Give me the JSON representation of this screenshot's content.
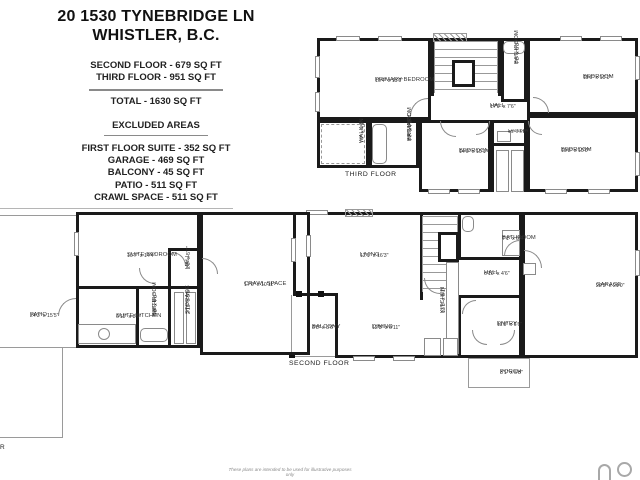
{
  "header": {
    "title_line1": "20 1530 TYNEBRIDGE LN",
    "title_line2": "WHISTLER, B.C.",
    "included": [
      "SECOND FLOOR - 679 SQ FT",
      "THIRD FLOOR - 951 SQ FT"
    ],
    "total": "TOTAL - 1630 SQ FT",
    "excluded_heading": "EXCLUDED AREAS",
    "excluded": [
      "FIRST FLOOR SUITE - 352 SQ FT",
      "GARAGE - 469 SQ FT",
      "BALCONY - 45 SQ FT",
      "PATIO - 511 SQ FT",
      "CRAWL SPACE - 511 SQ FT"
    ]
  },
  "colors": {
    "wall": "#1a1a1a",
    "thin_line": "#9a9a9a",
    "label_text": "#333333"
  },
  "floors": [
    {
      "name": "THIRD FLOOR",
      "walls": [
        {
          "t": "rect",
          "x": 317,
          "y": 38,
          "w": 114,
          "h": 82
        },
        {
          "t": "rect",
          "x": 431,
          "y": 38,
          "w": 70,
          "h": 58,
          "s": "tlr"
        },
        {
          "t": "rect",
          "x": 501,
          "y": 38,
          "w": 26,
          "h": 64
        },
        {
          "t": "rect",
          "x": 527,
          "y": 38,
          "w": 111,
          "h": 77
        },
        {
          "t": "rect",
          "x": 317,
          "y": 120,
          "w": 52,
          "h": 48
        },
        {
          "t": "rect",
          "x": 369,
          "y": 120,
          "w": 50,
          "h": 48
        },
        {
          "t": "rect",
          "x": 419,
          "y": 120,
          "w": 72,
          "h": 72
        },
        {
          "t": "rect",
          "x": 491,
          "y": 120,
          "w": 36,
          "h": 26
        },
        {
          "t": "rect",
          "x": 527,
          "y": 115,
          "w": 111,
          "h": 77
        },
        {
          "t": "bar",
          "x": 491,
          "y": 146,
          "w": 3,
          "h": 46
        },
        {
          "t": "bar",
          "x": 524,
          "y": 146,
          "w": 3,
          "h": 46
        }
      ],
      "details": [
        {
          "t": "hatch",
          "x": 433,
          "y": 33,
          "w": 34,
          "h": 9
        },
        {
          "t": "stairs",
          "x": 434,
          "y": 41,
          "w": 64,
          "h": 52
        },
        {
          "t": "box",
          "x": 452,
          "y": 60,
          "w": 23,
          "h": 27
        },
        {
          "t": "dash",
          "x": 321,
          "y": 124,
          "w": 44,
          "h": 40
        },
        {
          "t": "fix",
          "x": 372,
          "y": 124,
          "w": 15,
          "h": 40
        },
        {
          "t": "fix",
          "x": 503,
          "y": 41,
          "w": 22,
          "h": 13
        },
        {
          "t": "tbox",
          "x": 497,
          "y": 131,
          "w": 14,
          "h": 11
        },
        {
          "t": "tbox",
          "x": 496,
          "y": 150,
          "w": 13,
          "h": 42
        },
        {
          "t": "tbox",
          "x": 511,
          "y": 150,
          "w": 13,
          "h": 42
        },
        {
          "t": "win",
          "x": 336,
          "y": 36,
          "w": 24,
          "h": 5
        },
        {
          "t": "win",
          "x": 378,
          "y": 36,
          "w": 24,
          "h": 5
        },
        {
          "t": "win",
          "x": 315,
          "y": 56,
          "w": 5,
          "h": 22
        },
        {
          "t": "win",
          "x": 315,
          "y": 92,
          "w": 5,
          "h": 20
        },
        {
          "t": "win",
          "x": 560,
          "y": 36,
          "w": 22,
          "h": 5
        },
        {
          "t": "win",
          "x": 600,
          "y": 36,
          "w": 22,
          "h": 5
        },
        {
          "t": "win",
          "x": 635,
          "y": 56,
          "w": 5,
          "h": 24
        },
        {
          "t": "win",
          "x": 635,
          "y": 152,
          "w": 5,
          "h": 24
        },
        {
          "t": "win",
          "x": 545,
          "y": 189,
          "w": 22,
          "h": 5
        },
        {
          "t": "win",
          "x": 588,
          "y": 189,
          "w": 22,
          "h": 5
        },
        {
          "t": "win",
          "x": 428,
          "y": 189,
          "w": 22,
          "h": 5
        },
        {
          "t": "win",
          "x": 458,
          "y": 189,
          "w": 22,
          "h": 5
        },
        {
          "t": "arc",
          "x": 410,
          "y": 98,
          "w": 18,
          "h": 18,
          "c": "tl"
        },
        {
          "t": "arc",
          "x": 533,
          "y": 97,
          "w": 16,
          "h": 16,
          "c": "tr"
        },
        {
          "t": "arc",
          "x": 440,
          "y": 121,
          "w": 16,
          "h": 16,
          "c": "bl"
        },
        {
          "t": "arc",
          "x": 476,
          "y": 121,
          "w": 14,
          "h": 14,
          "c": "br"
        },
        {
          "t": "arc",
          "x": 528,
          "y": 121,
          "w": 14,
          "h": 14,
          "c": "bl"
        }
      ],
      "labels": [
        {
          "n": "PRIMARY BEDROOM",
          "d": "16'4\" x 11'0\"",
          "x": 375,
          "y": 77
        },
        {
          "n": "WALK-IN",
          "d": "7'7\" x 4'9\"",
          "x": 359,
          "y": 143,
          "r": 1
        },
        {
          "n": "PRIMARY",
          "n2": "BATHROOM",
          "d": "7'7\" x 7'2\"",
          "x": 407,
          "y": 141,
          "r": 1
        },
        {
          "n": "BATHROOM",
          "d": "7'5\" x 5'3\"",
          "x": 514,
          "y": 64,
          "r": 1
        },
        {
          "n": "HALL",
          "d": "17'9\" x 7'6\"",
          "x": 490,
          "y": 103
        },
        {
          "n": "BEDROOM",
          "d": "11'6\" x 10'1\"",
          "x": 583,
          "y": 74
        },
        {
          "n": "BEDROOM",
          "d": "14'0\" x 10'1\"",
          "x": 459,
          "y": 148
        },
        {
          "n": "LAUNDRY",
          "d": "4'5\" x 4'1\"",
          "x": 508,
          "y": 128,
          "s": 4.2
        },
        {
          "n": "BEDROOM",
          "d": "10'8\" x 10'0\"",
          "x": 561,
          "y": 147
        },
        {
          "n": "THIRD FLOOR",
          "x": 345,
          "y": 171,
          "f": 1
        }
      ]
    },
    {
      "name": "SECOND FLOOR",
      "walls": [
        {
          "t": "rect",
          "x": 293,
          "y": 212,
          "w": 229,
          "h": 84,
          "s": "tlr"
        },
        {
          "t": "bar",
          "x": 293,
          "y": 293,
          "w": 45,
          "h": 3
        },
        {
          "t": "rect",
          "x": 335,
          "y": 293,
          "w": 187,
          "h": 65,
          "s": "lbr"
        },
        {
          "t": "rect",
          "x": 522,
          "y": 212,
          "w": 116,
          "h": 146
        },
        {
          "t": "bar",
          "x": 420,
          "y": 212,
          "w": 3,
          "h": 88
        },
        {
          "t": "bar",
          "x": 458,
          "y": 212,
          "w": 3,
          "h": 48
        },
        {
          "t": "bar",
          "x": 461,
          "y": 257,
          "w": 61,
          "h": 3
        },
        {
          "t": "bar",
          "x": 458,
          "y": 295,
          "w": 3,
          "h": 63
        },
        {
          "t": "bar",
          "x": 461,
          "y": 295,
          "w": 61,
          "h": 3
        },
        {
          "t": "rect",
          "x": 291,
          "y": 295,
          "w": 44,
          "h": 62,
          "s": "lb",
          "k": "thin"
        },
        {
          "t": "rect",
          "x": 468,
          "y": 358,
          "w": 62,
          "h": 30,
          "k": "thin"
        }
      ],
      "details": [
        {
          "t": "hatch",
          "x": 345,
          "y": 209,
          "w": 28,
          "h": 8
        },
        {
          "t": "stairs",
          "x": 422,
          "y": 216,
          "w": 36,
          "h": 76
        },
        {
          "t": "box",
          "x": 438,
          "y": 232,
          "w": 21,
          "h": 30
        },
        {
          "t": "post",
          "x": 296,
          "y": 291,
          "w": 6,
          "h": 6
        },
        {
          "t": "post",
          "x": 318,
          "y": 291,
          "w": 6,
          "h": 6
        },
        {
          "t": "post",
          "x": 289,
          "y": 352,
          "w": 6,
          "h": 6
        },
        {
          "t": "tbox",
          "x": 446,
          "y": 262,
          "w": 13,
          "h": 92
        },
        {
          "t": "tbox",
          "x": 424,
          "y": 338,
          "w": 17,
          "h": 18
        },
        {
          "t": "tbox",
          "x": 443,
          "y": 338,
          "w": 15,
          "h": 18
        },
        {
          "t": "tbox",
          "x": 502,
          "y": 230,
          "w": 18,
          "h": 26
        },
        {
          "t": "fix",
          "x": 462,
          "y": 216,
          "w": 12,
          "h": 16
        },
        {
          "t": "tbox",
          "x": 523,
          "y": 263,
          "w": 13,
          "h": 12
        },
        {
          "t": "win",
          "x": 291,
          "y": 238,
          "w": 5,
          "h": 24
        },
        {
          "t": "win",
          "x": 306,
          "y": 210,
          "w": 22,
          "h": 5
        },
        {
          "t": "win",
          "x": 353,
          "y": 356,
          "w": 22,
          "h": 5
        },
        {
          "t": "win",
          "x": 393,
          "y": 356,
          "w": 22,
          "h": 5
        },
        {
          "t": "win",
          "x": 635,
          "y": 250,
          "w": 5,
          "h": 26
        },
        {
          "t": "arc",
          "x": 504,
          "y": 240,
          "w": 16,
          "h": 16,
          "c": "tl"
        },
        {
          "t": "arc",
          "x": 524,
          "y": 250,
          "w": 18,
          "h": 18,
          "c": "tr"
        },
        {
          "t": "arc",
          "x": 462,
          "y": 300,
          "w": 14,
          "h": 14,
          "c": "tl"
        },
        {
          "t": "arc",
          "x": 472,
          "y": 330,
          "w": 15,
          "h": 15,
          "c": "bl"
        },
        {
          "t": "arc",
          "x": 500,
          "y": 330,
          "w": 15,
          "h": 15,
          "c": "br"
        },
        {
          "t": "arc",
          "x": 424,
          "y": 278,
          "w": 16,
          "h": 16,
          "c": "bl"
        }
      ],
      "labels": [
        {
          "n": "LIVING",
          "d": "12'1\" x 16'3\"",
          "x": 360,
          "y": 252
        },
        {
          "n": "BALCONY",
          "d": "8'5\" x 5'6\"",
          "x": 312,
          "y": 324
        },
        {
          "n": "DINING",
          "d": "12'8\" x 6'11\"",
          "x": 372,
          "y": 324
        },
        {
          "n": "KITCHEN",
          "d": "13'8\" x 8'1\"",
          "x": 440,
          "y": 313,
          "r": 1
        },
        {
          "n": "BATHROOM",
          "d": "7'1\" x 5'4\"",
          "x": 502,
          "y": 235
        },
        {
          "n": "HALL",
          "d": "6'10\" x 4'6\"",
          "x": 484,
          "y": 270
        },
        {
          "n": "GARAGE",
          "d": "22'3\" x 21'0\"",
          "x": 596,
          "y": 282
        },
        {
          "n": "ENTRY",
          "d": "11'8\" x 6'6\"",
          "x": 497,
          "y": 321
        },
        {
          "n": "PORCH",
          "d": "8'1\" x 5'8\"",
          "x": 500,
          "y": 369
        },
        {
          "n": "SECOND FLOOR",
          "x": 289,
          "y": 360,
          "f": 1
        }
      ]
    },
    {
      "name": "FIRST FLOOR",
      "walls": [
        {
          "t": "line",
          "x": 0,
          "y": 208,
          "w": 233,
          "h": 1
        },
        {
          "t": "rect",
          "x": 0,
          "y": 215,
          "w": 76,
          "h": 133,
          "s": "tb",
          "k": "thin"
        },
        {
          "t": "rect",
          "x": 0,
          "y": 348,
          "w": 63,
          "h": 90,
          "s": "rb",
          "k": "thin"
        },
        {
          "t": "rect",
          "x": 76,
          "y": 212,
          "w": 124,
          "h": 136
        },
        {
          "t": "rect",
          "x": 200,
          "y": 212,
          "w": 110,
          "h": 143
        },
        {
          "t": "bar",
          "x": 76,
          "y": 286,
          "w": 96,
          "h": 3
        },
        {
          "t": "bar",
          "x": 136,
          "y": 286,
          "w": 3,
          "h": 62
        },
        {
          "t": "bar",
          "x": 168,
          "y": 248,
          "w": 3,
          "h": 100
        },
        {
          "t": "bar",
          "x": 168,
          "y": 248,
          "w": 32,
          "h": 3
        },
        {
          "t": "bar",
          "x": 168,
          "y": 286,
          "w": 32,
          "h": 3
        }
      ],
      "details": [
        {
          "t": "tbox",
          "x": 174,
          "y": 292,
          "w": 10,
          "h": 52
        },
        {
          "t": "tbox",
          "x": 186,
          "y": 292,
          "w": 10,
          "h": 52
        },
        {
          "t": "fix",
          "x": 140,
          "y": 328,
          "w": 28,
          "h": 14
        },
        {
          "t": "tbox",
          "x": 78,
          "y": 324,
          "w": 58,
          "h": 20
        },
        {
          "t": "circ",
          "x": 98,
          "y": 328,
          "d": 12
        },
        {
          "t": "win",
          "x": 74,
          "y": 232,
          "w": 5,
          "h": 24
        },
        {
          "t": "win",
          "x": 306,
          "y": 235,
          "w": 5,
          "h": 22
        },
        {
          "t": "arc",
          "x": 139,
          "y": 268,
          "w": 16,
          "h": 16,
          "c": "bl"
        },
        {
          "t": "arc",
          "x": 172,
          "y": 252,
          "w": 14,
          "h": 14,
          "c": "tr"
        },
        {
          "t": "arc",
          "x": 202,
          "y": 258,
          "w": 16,
          "h": 16,
          "c": "tr"
        },
        {
          "t": "arc",
          "x": 58,
          "y": 298,
          "w": 18,
          "h": 18,
          "c": "tl"
        }
      ],
      "labels": [
        {
          "n": "SUITE BEDROOM",
          "d": "10'7\" x 14'4\"",
          "x": 127,
          "y": 252
        },
        {
          "n": "PATIO",
          "d": "24'3\" x 15'5\"",
          "x": 30,
          "y": 312
        },
        {
          "n": "SUITE KITCHEN",
          "d": "6'11\" x 8'0\"",
          "x": 116,
          "y": 313
        },
        {
          "n": "SUITE",
          "n2": "BATHROOM",
          "d": "5'0\" x 7'6\"",
          "x": 152,
          "y": 316,
          "r": 1
        },
        {
          "n": "HALL",
          "d": "2'9\" x 5'7\"",
          "x": 185,
          "y": 269,
          "r": 1
        },
        {
          "n": "STORAGE",
          "d": "2'10\" x 9'5\"",
          "x": 185,
          "y": 314,
          "r": 1
        },
        {
          "n": "CRAWL SPACE",
          "d": "17'6\" x 10'11\"",
          "x": 244,
          "y": 281
        }
      ]
    }
  ],
  "footer": {
    "disclaimer": "These plans are intended to be used for illustrative purposes only",
    "fragment": "R"
  }
}
